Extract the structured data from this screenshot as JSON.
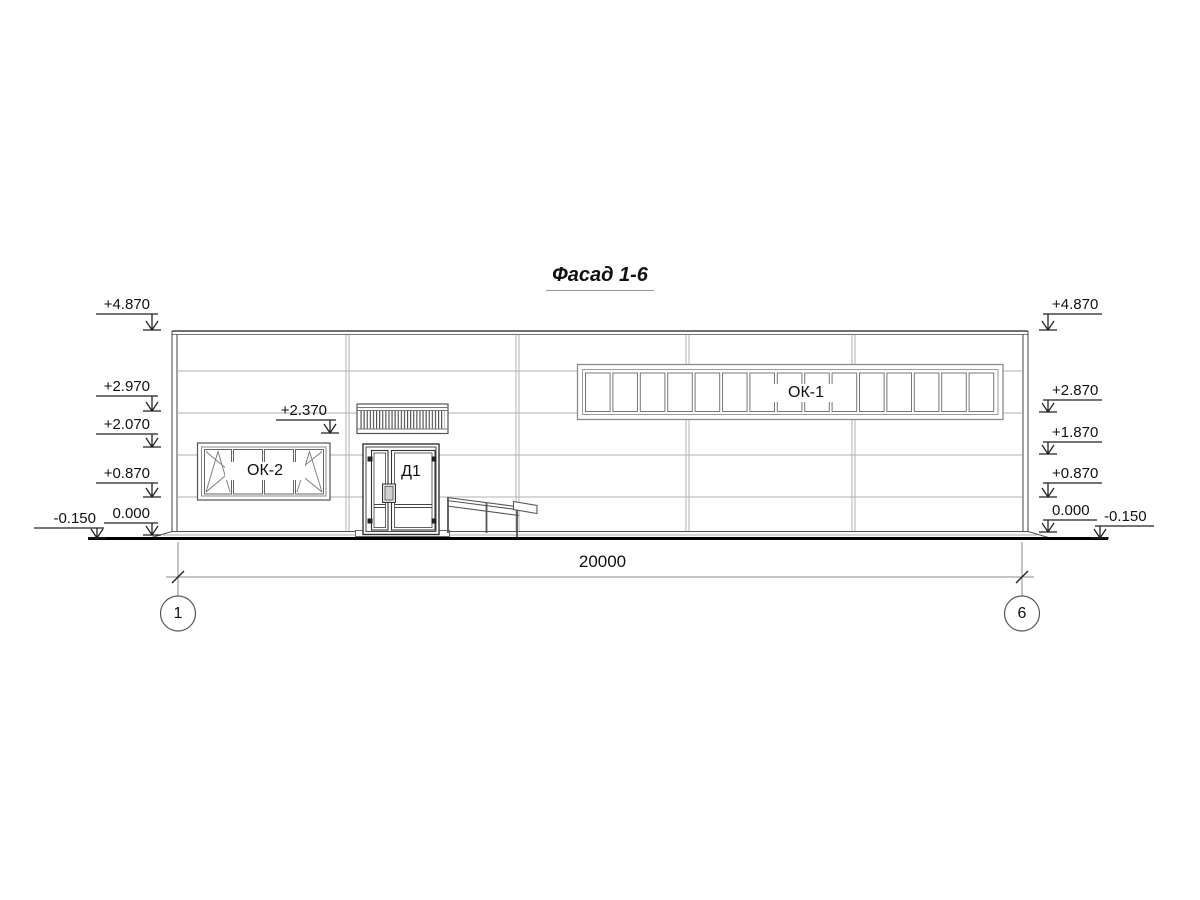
{
  "title": "Фасад 1-6",
  "elevation_marks": {
    "left": [
      "+4.870",
      "+2.970",
      "+2.070",
      "+0.870",
      "0.000",
      "-0.150"
    ],
    "right": [
      "+4.870",
      "+2.870",
      "+1.870",
      "+0.870",
      "0.000",
      "-0.150"
    ],
    "entrance": "+2.370"
  },
  "labels": {
    "window_strip": "ОК-1",
    "window_left": "ОК-2",
    "door": "Д1"
  },
  "dimension": {
    "total_length": "20000"
  },
  "axes": {
    "left": "1",
    "right": "6"
  },
  "colors": {
    "text": "#111111",
    "line_dark": "#333333",
    "line_mid": "#666666",
    "line_light": "#b0b0b0",
    "ground": "#000000"
  }
}
